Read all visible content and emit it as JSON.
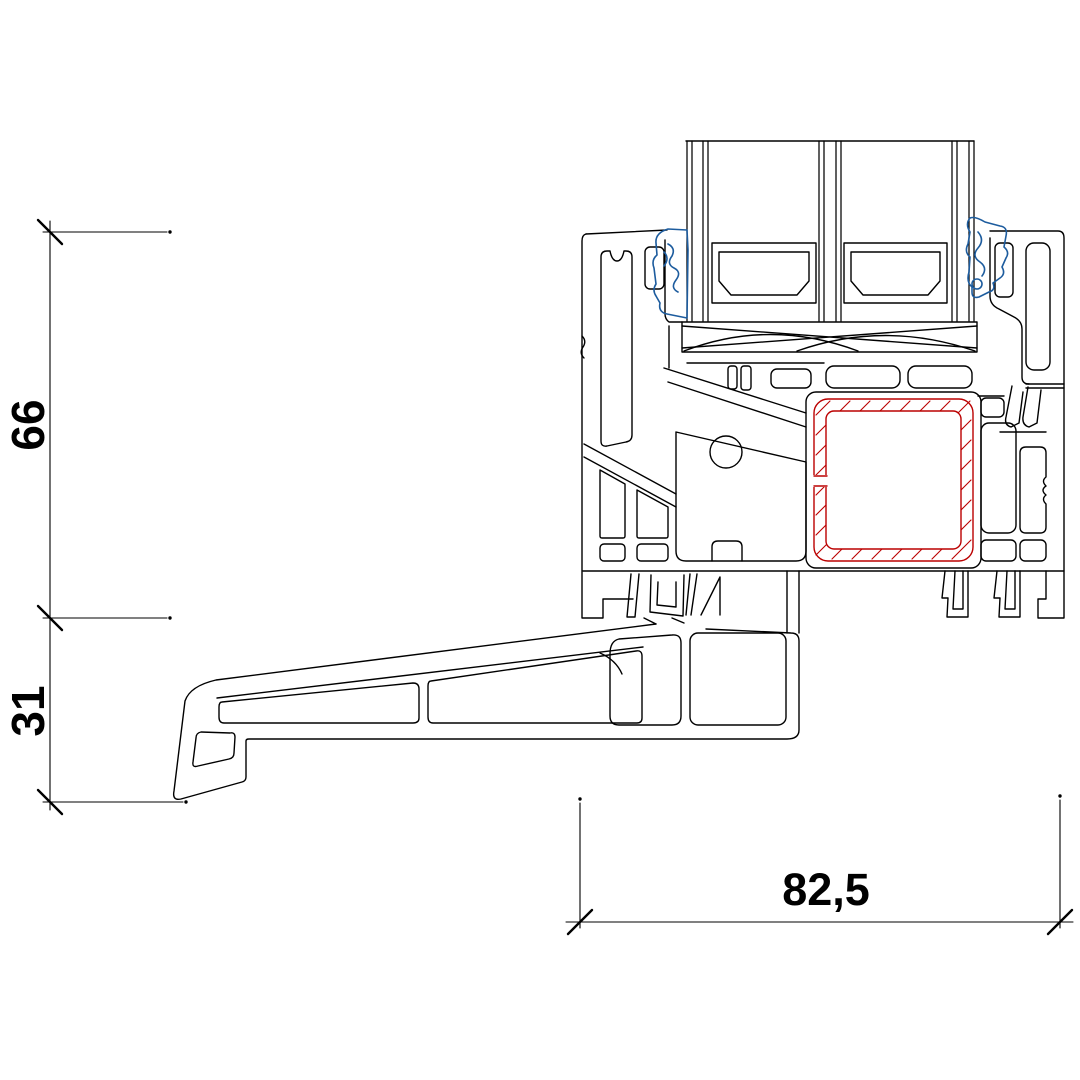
{
  "dimensions": {
    "left_top": {
      "label": "66"
    },
    "left_bottom": {
      "label": "31"
    },
    "bottom": {
      "label": "82,5"
    }
  },
  "colors": {
    "line": "#000000",
    "steel": "#bb0000",
    "gasket": "#1d5c9e",
    "text": "#000000",
    "background": "#ffffff"
  }
}
